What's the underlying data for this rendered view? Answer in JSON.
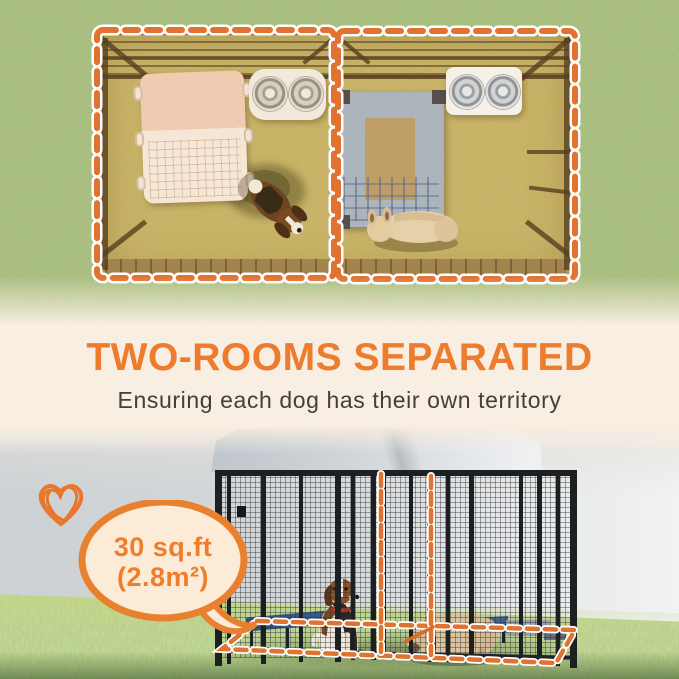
{
  "palette": {
    "accent_orange": "#ED7C2F",
    "dash_orange": "#E1722F",
    "cream_background": "#F8EEE1",
    "bubble_fill": "#FCEBD6",
    "bubble_border": "#E8812F",
    "subtitle_gray": "#41403A",
    "grass_green": "#76864C",
    "kennel_black": "#1D2023",
    "bed_blue": "#31507C"
  },
  "headline": {
    "title": "TWO-ROOMS SEPARATED",
    "subtitle": "Ensuring each dog has their own territory"
  },
  "area_badge": {
    "line1": "30 sq.ft",
    "line2": "(2.8m²)"
  },
  "aerial_view": {
    "rooms": [
      {
        "name": "left-room",
        "items": [
          "pet-mat",
          "double-bowl-feeder",
          "beagle-dog"
        ]
      },
      {
        "name": "right-room",
        "items": [
          "elevated-pet-bed",
          "double-bowl-feeder",
          "bulldog-dog"
        ]
      }
    ],
    "outline_style": "orange-dashed"
  },
  "photo_view": {
    "items": [
      "canopy-cover",
      "wire-mesh-kennel",
      "elevated-bed-left",
      "elevated-bed-right",
      "beagle-dog",
      "bulldog-dog",
      "footprint-outline",
      "divider-highlight"
    ],
    "icons": [
      "heart-doodle-icon",
      "speech-bubble"
    ]
  }
}
